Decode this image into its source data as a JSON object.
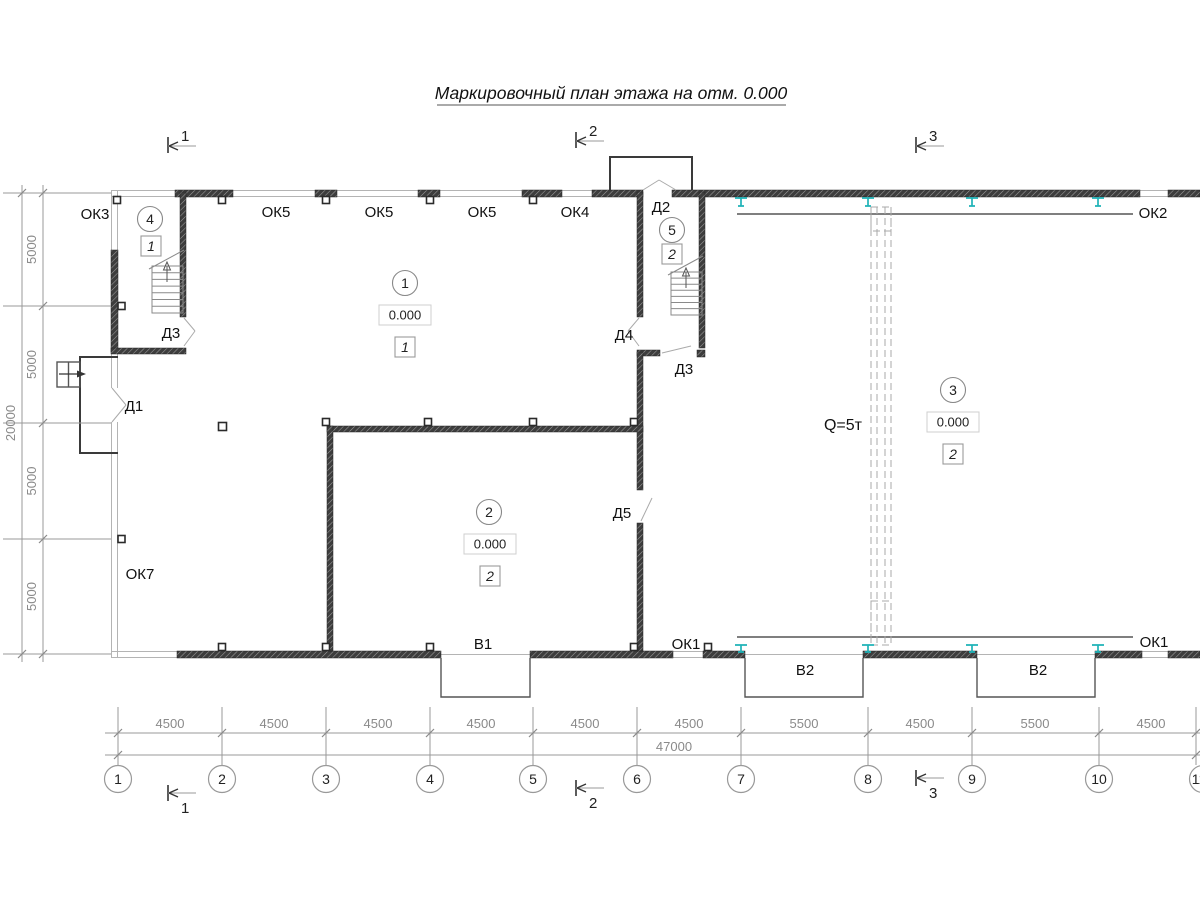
{
  "title": "Маркировочный план этажа на отм. 0.000",
  "section_marks": {
    "s1": "1",
    "s2": "2",
    "s3": "3"
  },
  "axes": [
    "1",
    "2",
    "3",
    "4",
    "5",
    "6",
    "7",
    "8",
    "9",
    "10",
    "11"
  ],
  "dims_bottom": [
    "4500",
    "4500",
    "4500",
    "4500",
    "4500",
    "4500",
    "5500",
    "4500",
    "5500",
    "4500"
  ],
  "dims_bottom_total": "47000",
  "dims_left": [
    "5000",
    "5000",
    "5000",
    "5000"
  ],
  "dims_left_total": "20000",
  "rooms": {
    "r1": {
      "num": "1",
      "elev": "0.000",
      "type": "1"
    },
    "r2": {
      "num": "2",
      "elev": "0.000",
      "type": "2"
    },
    "r3": {
      "num": "3",
      "elev": "0.000",
      "type": "2"
    },
    "r4": {
      "num": "4",
      "type": "1"
    },
    "r5": {
      "num": "5",
      "type": "2"
    }
  },
  "openings": {
    "ok1": "ОК1",
    "ok2": "ОК2",
    "ok3": "ОК3",
    "ok4": "ОК4",
    "ok5": "ОК5",
    "ok7": "ОК7",
    "d1": "Д1",
    "d2": "Д2",
    "d3": "Д3",
    "d4": "Д4",
    "d5": "Д5",
    "v1": "В1",
    "v2": "В2"
  },
  "crane_label": "Q=5т",
  "colors": {
    "wall": "#3d3d3d",
    "window": "#b4b4b4",
    "dimension": "#8a8a8a",
    "steel_column": "#1fb3b8"
  }
}
